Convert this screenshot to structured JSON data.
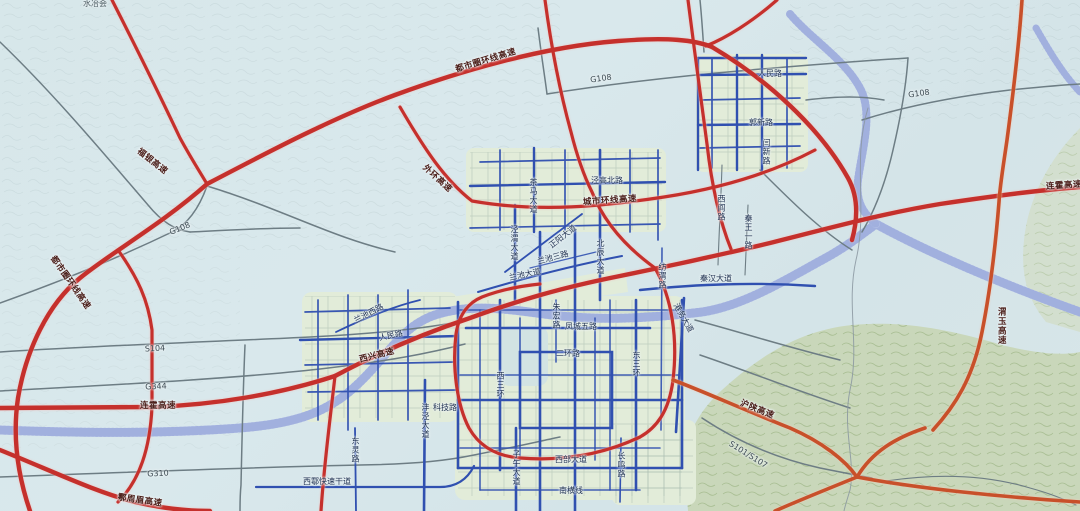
{
  "meta": {
    "title": "都市圈干线公路网规划图",
    "region_hint": "西安都市圈",
    "top_place_label": "水冶会"
  },
  "palette": {
    "expressway_red": "#c5302c",
    "expressway_orange": "#c8502a",
    "urban_expressway_blue": "#3050b0",
    "national_road_gray": "#6d7d84",
    "minor_road_teal": "#9db3a6",
    "water_hatch": "#93a3d8",
    "water_base": "#ccd6f0",
    "mountain_green": "#c9d7ba",
    "urban_fill": "#e2ecd9",
    "background": "#d7e7ea"
  },
  "map": {
    "labels": [
      {
        "text": "水冶会",
        "x": 95,
        "y": 4,
        "rot": 0,
        "cls": "place"
      },
      {
        "text": "福银高速",
        "x": 152,
        "y": 162,
        "rot": 38,
        "cls": "hwy"
      },
      {
        "text": "都市圈环线高速",
        "x": 70,
        "y": 283,
        "rot": 55,
        "cls": "hwy"
      },
      {
        "text": "都市圈环线高速",
        "x": 486,
        "y": 61,
        "rot": -17,
        "cls": "hwy"
      },
      {
        "text": "G108",
        "x": 180,
        "y": 229,
        "rot": -22,
        "cls": "g"
      },
      {
        "text": "G108",
        "x": 601,
        "y": 79,
        "rot": -8,
        "cls": "g"
      },
      {
        "text": "G108",
        "x": 919,
        "y": 94,
        "rot": -8,
        "cls": "g"
      },
      {
        "text": "连霍高速",
        "x": 158,
        "y": 406,
        "rot": 0,
        "cls": "hwy"
      },
      {
        "text": "连霍高速",
        "x": 1064,
        "y": 186,
        "rot": -4,
        "cls": "hwy"
      },
      {
        "text": "G344",
        "x": 156,
        "y": 387,
        "rot": -3,
        "cls": "g"
      },
      {
        "text": "S104",
        "x": 155,
        "y": 349,
        "rot": -3,
        "cls": "g"
      },
      {
        "text": "G310",
        "x": 158,
        "y": 474,
        "rot": -3,
        "cls": "g"
      },
      {
        "text": "鄠周眉高速",
        "x": 140,
        "y": 501,
        "rot": 8,
        "cls": "hwy"
      },
      {
        "text": "西兴高速",
        "x": 377,
        "y": 356,
        "rot": -14,
        "cls": "hwy"
      },
      {
        "text": "外环高速",
        "x": 437,
        "y": 179,
        "rot": 42,
        "cls": "hwy"
      },
      {
        "text": "城市环线高速",
        "x": 610,
        "y": 201,
        "rot": -4,
        "cls": "hwy"
      },
      {
        "text": "沪陕高速",
        "x": 757,
        "y": 410,
        "rot": 22,
        "cls": "hwy"
      },
      {
        "text": "渭玉高速",
        "x": 1001,
        "y": 326,
        "rot": 0,
        "cls": "hwy v"
      },
      {
        "text": "S101/S107",
        "x": 748,
        "y": 455,
        "rot": 32,
        "cls": "g"
      },
      {
        "text": "人民路",
        "x": 770,
        "y": 74,
        "rot": 0,
        "cls": "road"
      },
      {
        "text": "郭新路",
        "x": 761,
        "y": 123,
        "rot": 0,
        "cls": "road"
      },
      {
        "text": "闫新路",
        "x": 766,
        "y": 152,
        "rot": 0,
        "cls": "road v"
      },
      {
        "text": "秦王一路",
        "x": 748,
        "y": 232,
        "rot": 0,
        "cls": "road v"
      },
      {
        "text": "西阎路",
        "x": 721,
        "y": 208,
        "rot": 0,
        "cls": "road v"
      },
      {
        "text": "纺渭路",
        "x": 662,
        "y": 276,
        "rot": 0,
        "cls": "road v"
      },
      {
        "text": "秦汉大道",
        "x": 716,
        "y": 279,
        "rot": 0,
        "cls": "road"
      },
      {
        "text": "泾高北路",
        "x": 607,
        "y": 181,
        "rot": 0,
        "cls": "road"
      },
      {
        "text": "茶马大道",
        "x": 533,
        "y": 196,
        "rot": 0,
        "cls": "road v"
      },
      {
        "text": "泾渭大道",
        "x": 514,
        "y": 243,
        "rot": 0,
        "cls": "road v"
      },
      {
        "text": "正阳大道",
        "x": 563,
        "y": 237,
        "rot": -38,
        "cls": "road"
      },
      {
        "text": "兰池三路",
        "x": 553,
        "y": 258,
        "rot": -15,
        "cls": "road"
      },
      {
        "text": "兰池大道",
        "x": 525,
        "y": 275,
        "rot": -12,
        "cls": "road"
      },
      {
        "text": "北辰大道",
        "x": 600,
        "y": 257,
        "rot": 0,
        "cls": "road v"
      },
      {
        "text": "兰池西路",
        "x": 369,
        "y": 314,
        "rot": -28,
        "cls": "road"
      },
      {
        "text": "人民路",
        "x": 391,
        "y": 336,
        "rot": -12,
        "cls": "road"
      },
      {
        "text": "朱宏路",
        "x": 556,
        "y": 316,
        "rot": 0,
        "cls": "road v"
      },
      {
        "text": "凤城五路",
        "x": 581,
        "y": 327,
        "rot": 0,
        "cls": "road"
      },
      {
        "text": "二环路",
        "x": 568,
        "y": 354,
        "rot": 0,
        "cls": "road"
      },
      {
        "text": "东三环",
        "x": 636,
        "y": 364,
        "rot": 0,
        "cls": "road v"
      },
      {
        "text": "西三环",
        "x": 500,
        "y": 385,
        "rot": 0,
        "cls": "road v"
      },
      {
        "text": "港务大道",
        "x": 683,
        "y": 318,
        "rot": 60,
        "cls": "road"
      },
      {
        "text": "沣泾大道",
        "x": 425,
        "y": 421,
        "rot": 0,
        "cls": "road v"
      },
      {
        "text": "科技路",
        "x": 445,
        "y": 408,
        "rot": 0,
        "cls": "road"
      },
      {
        "text": "子午大道",
        "x": 516,
        "y": 468,
        "rot": 0,
        "cls": "road v"
      },
      {
        "text": "西部大道",
        "x": 571,
        "y": 460,
        "rot": 0,
        "cls": "road"
      },
      {
        "text": "南横线",
        "x": 571,
        "y": 491,
        "rot": 0,
        "cls": "road"
      },
      {
        "text": "东灵路",
        "x": 355,
        "y": 450,
        "rot": 0,
        "cls": "road v"
      },
      {
        "text": "西鄠快速干道",
        "x": 327,
        "y": 482,
        "rot": 0,
        "cls": "road"
      },
      {
        "text": "长鸣路",
        "x": 621,
        "y": 465,
        "rot": 0,
        "cls": "road v"
      }
    ]
  }
}
